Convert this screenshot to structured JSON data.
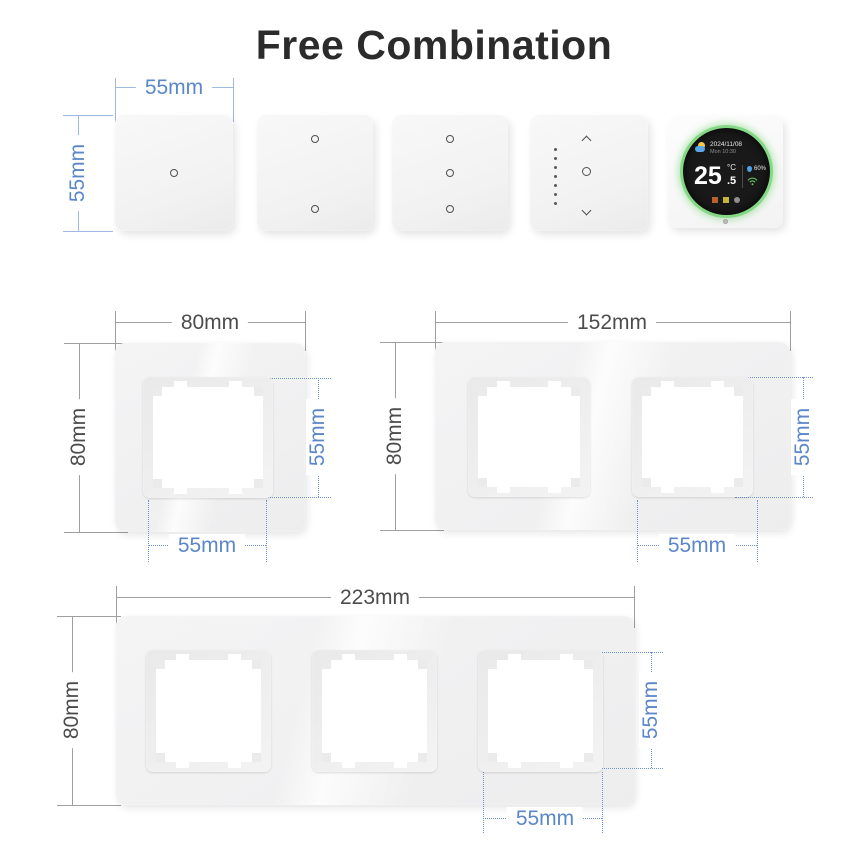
{
  "title": "Free Combination",
  "colors": {
    "dimension_blue_text": "#5b87c8",
    "dimension_blue_line": "#9fb8e2",
    "dimension_gray_line": "#9f9f9f",
    "dimension_gray_text": "#4c4c4c",
    "thermostat_ring_green": "#85d885"
  },
  "module_row": {
    "width_label": "55mm",
    "height_label": "55mm",
    "modules": [
      {
        "name": "one-gang-touch-switch"
      },
      {
        "name": "two-gang-touch-switch"
      },
      {
        "name": "three-gang-touch-switch"
      },
      {
        "name": "dimmer-switch"
      },
      {
        "name": "round-thermostat"
      }
    ]
  },
  "thermostat": {
    "date": "2024/11/08",
    "day_time": "Mon 10:30",
    "temperature": "25",
    "temperature_unit": "°C",
    "temperature_decimal": ".5",
    "humidity": "60%"
  },
  "frames": {
    "single": {
      "width_label": "80mm",
      "height_label": "80mm",
      "opening_width_label": "55mm",
      "opening_height_label": "55mm"
    },
    "double": {
      "width_label": "152mm",
      "height_label": "80mm",
      "opening_width_label": "55mm",
      "opening_height_label": "55mm"
    },
    "triple": {
      "width_label": "223mm",
      "height_label": "80mm",
      "opening_width_label": "55mm",
      "opening_height_label": "55mm"
    }
  }
}
